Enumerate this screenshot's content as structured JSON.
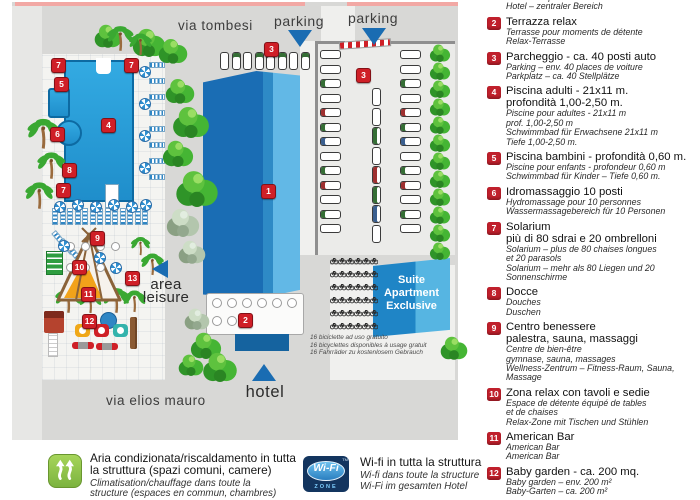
{
  "map": {
    "streets": {
      "top": "via tombesi",
      "bottom": "via elios mauro"
    },
    "parking_label_left": "parking",
    "parking_label_right": "parking",
    "hotel_label": "hotel",
    "area_leisure": [
      "area",
      "leisure"
    ],
    "suite_building": [
      "Suite",
      "Apartment",
      "Exclusive"
    ],
    "bike_note": [
      "16 biciclette ad uso gratuito",
      "16 bicyclettes disponibles à usage gratuit",
      "16 Fahrräder zu kostenlosem Gebrauch"
    ],
    "markers": [
      "1",
      "2",
      "3",
      "3",
      "4",
      "5",
      "6",
      "7",
      "7",
      "7",
      "8",
      "9",
      "10",
      "11",
      "12",
      "13"
    ]
  },
  "legend": {
    "items": [
      {
        "num": "1",
        "it": [],
        "tr": [
          "Hôtel – corps central",
          "Hotel – zentraler Bereich"
        ]
      },
      {
        "num": "2",
        "it": [
          "Terrazza relax"
        ],
        "tr": [
          "Terrasse pour moments de détente",
          "Relax-Terrasse"
        ]
      },
      {
        "num": "3",
        "it": [
          "Parcheggio - ca. 40 posti auto"
        ],
        "tr": [
          "Parking – env. 40 places de voiture",
          "Parkplatz – ca. 40 Stellplätze"
        ]
      },
      {
        "num": "4",
        "it": [
          "Piscina adulti - 21x11 m.",
          "profondità 1,00-2,50 m."
        ],
        "tr": [
          "Piscine pour adultes - 21x11 m",
          "prof. 1,00-2,50 m",
          "Schwimmbad für Erwachsene 21x11 m",
          "Tiefe 1,00-2,50 m."
        ]
      },
      {
        "num": "5",
        "it": [
          "Piscina bambini - profondità 0,60 m."
        ],
        "tr": [
          "Piscine pour enfants - profondeur 0,60 m",
          "Schwimmbad für Kinder – Tiefe 0,60 m."
        ]
      },
      {
        "num": "6",
        "it": [
          "Idromassaggio 10 posti"
        ],
        "tr": [
          "Hydromassage pour 10 personnes",
          "Wassermassagebereich für 10 Personen"
        ]
      },
      {
        "num": "7",
        "it": [
          "Solarium",
          "più di 80 sdrai e 20 ombrelloni"
        ],
        "tr": [
          "Solarium – plus de 80 chaises longues",
          "et 20 parasols",
          "Solarium – mehr als 80 Liegen und 20",
          "Sonnenschirme"
        ]
      },
      {
        "num": "8",
        "it": [
          "Docce"
        ],
        "tr": [
          "Douches",
          "Duschen"
        ]
      },
      {
        "num": "9",
        "it": [
          "Centro benessere",
          "palestra, sauna, massaggi"
        ],
        "tr": [
          "Centre de bien-être",
          "gymnase, sauna, massages",
          "Wellness-Zentrum – Fitness-Raum, Sauna,",
          "Massage"
        ]
      },
      {
        "num": "10",
        "it": [
          "Zona relax con tavoli e sedie"
        ],
        "tr": [
          "Espace de détente équipé de tables",
          "et de chaises",
          "Relax-Zone mit Tischen und Stühlen"
        ]
      },
      {
        "num": "11",
        "it": [
          "American Bar"
        ],
        "tr": [
          "American Bar",
          "American Bar"
        ]
      },
      {
        "num": "12",
        "it": [
          "Baby garden - ca. 200 mq."
        ],
        "tr": [
          "Baby garden – env. 200 m²",
          "Baby-Garten – ca. 200 m²"
        ]
      }
    ]
  },
  "footer": {
    "ac_lines": [
      "Aria condizionata/riscaldamento in tutta",
      "la struttura (spazi comuni, camere)"
    ],
    "ac_translation": [
      "Climatisation/chauffage dans toute la",
      "structure (espaces en commun, chambres)"
    ],
    "wifi_badge": {
      "label": "Wi-Fi",
      "zone": "ZONE",
      "tm": "TM"
    },
    "wifi_lines": [
      "Wi-fi in tutta la struttura"
    ],
    "wifi_translation": [
      "Wi-fi dans toute la structure",
      "Wi-Fi im gesamten Hotel"
    ]
  },
  "colors": {
    "marker_red": "#cf1f27",
    "legend_red": "#c0202c",
    "pool_blue": "#1f8ecb",
    "building_dark_blue": "#1a6db4",
    "building_light_blue": "#62b8e6",
    "street_gray": "#d8d8d6",
    "tree_green": "#45b534",
    "accent_pink": "#f2a8a4",
    "wifi_navy": "#13355f",
    "ac_green": "#8cc640",
    "triangle_blue": "#1a6cb2"
  }
}
